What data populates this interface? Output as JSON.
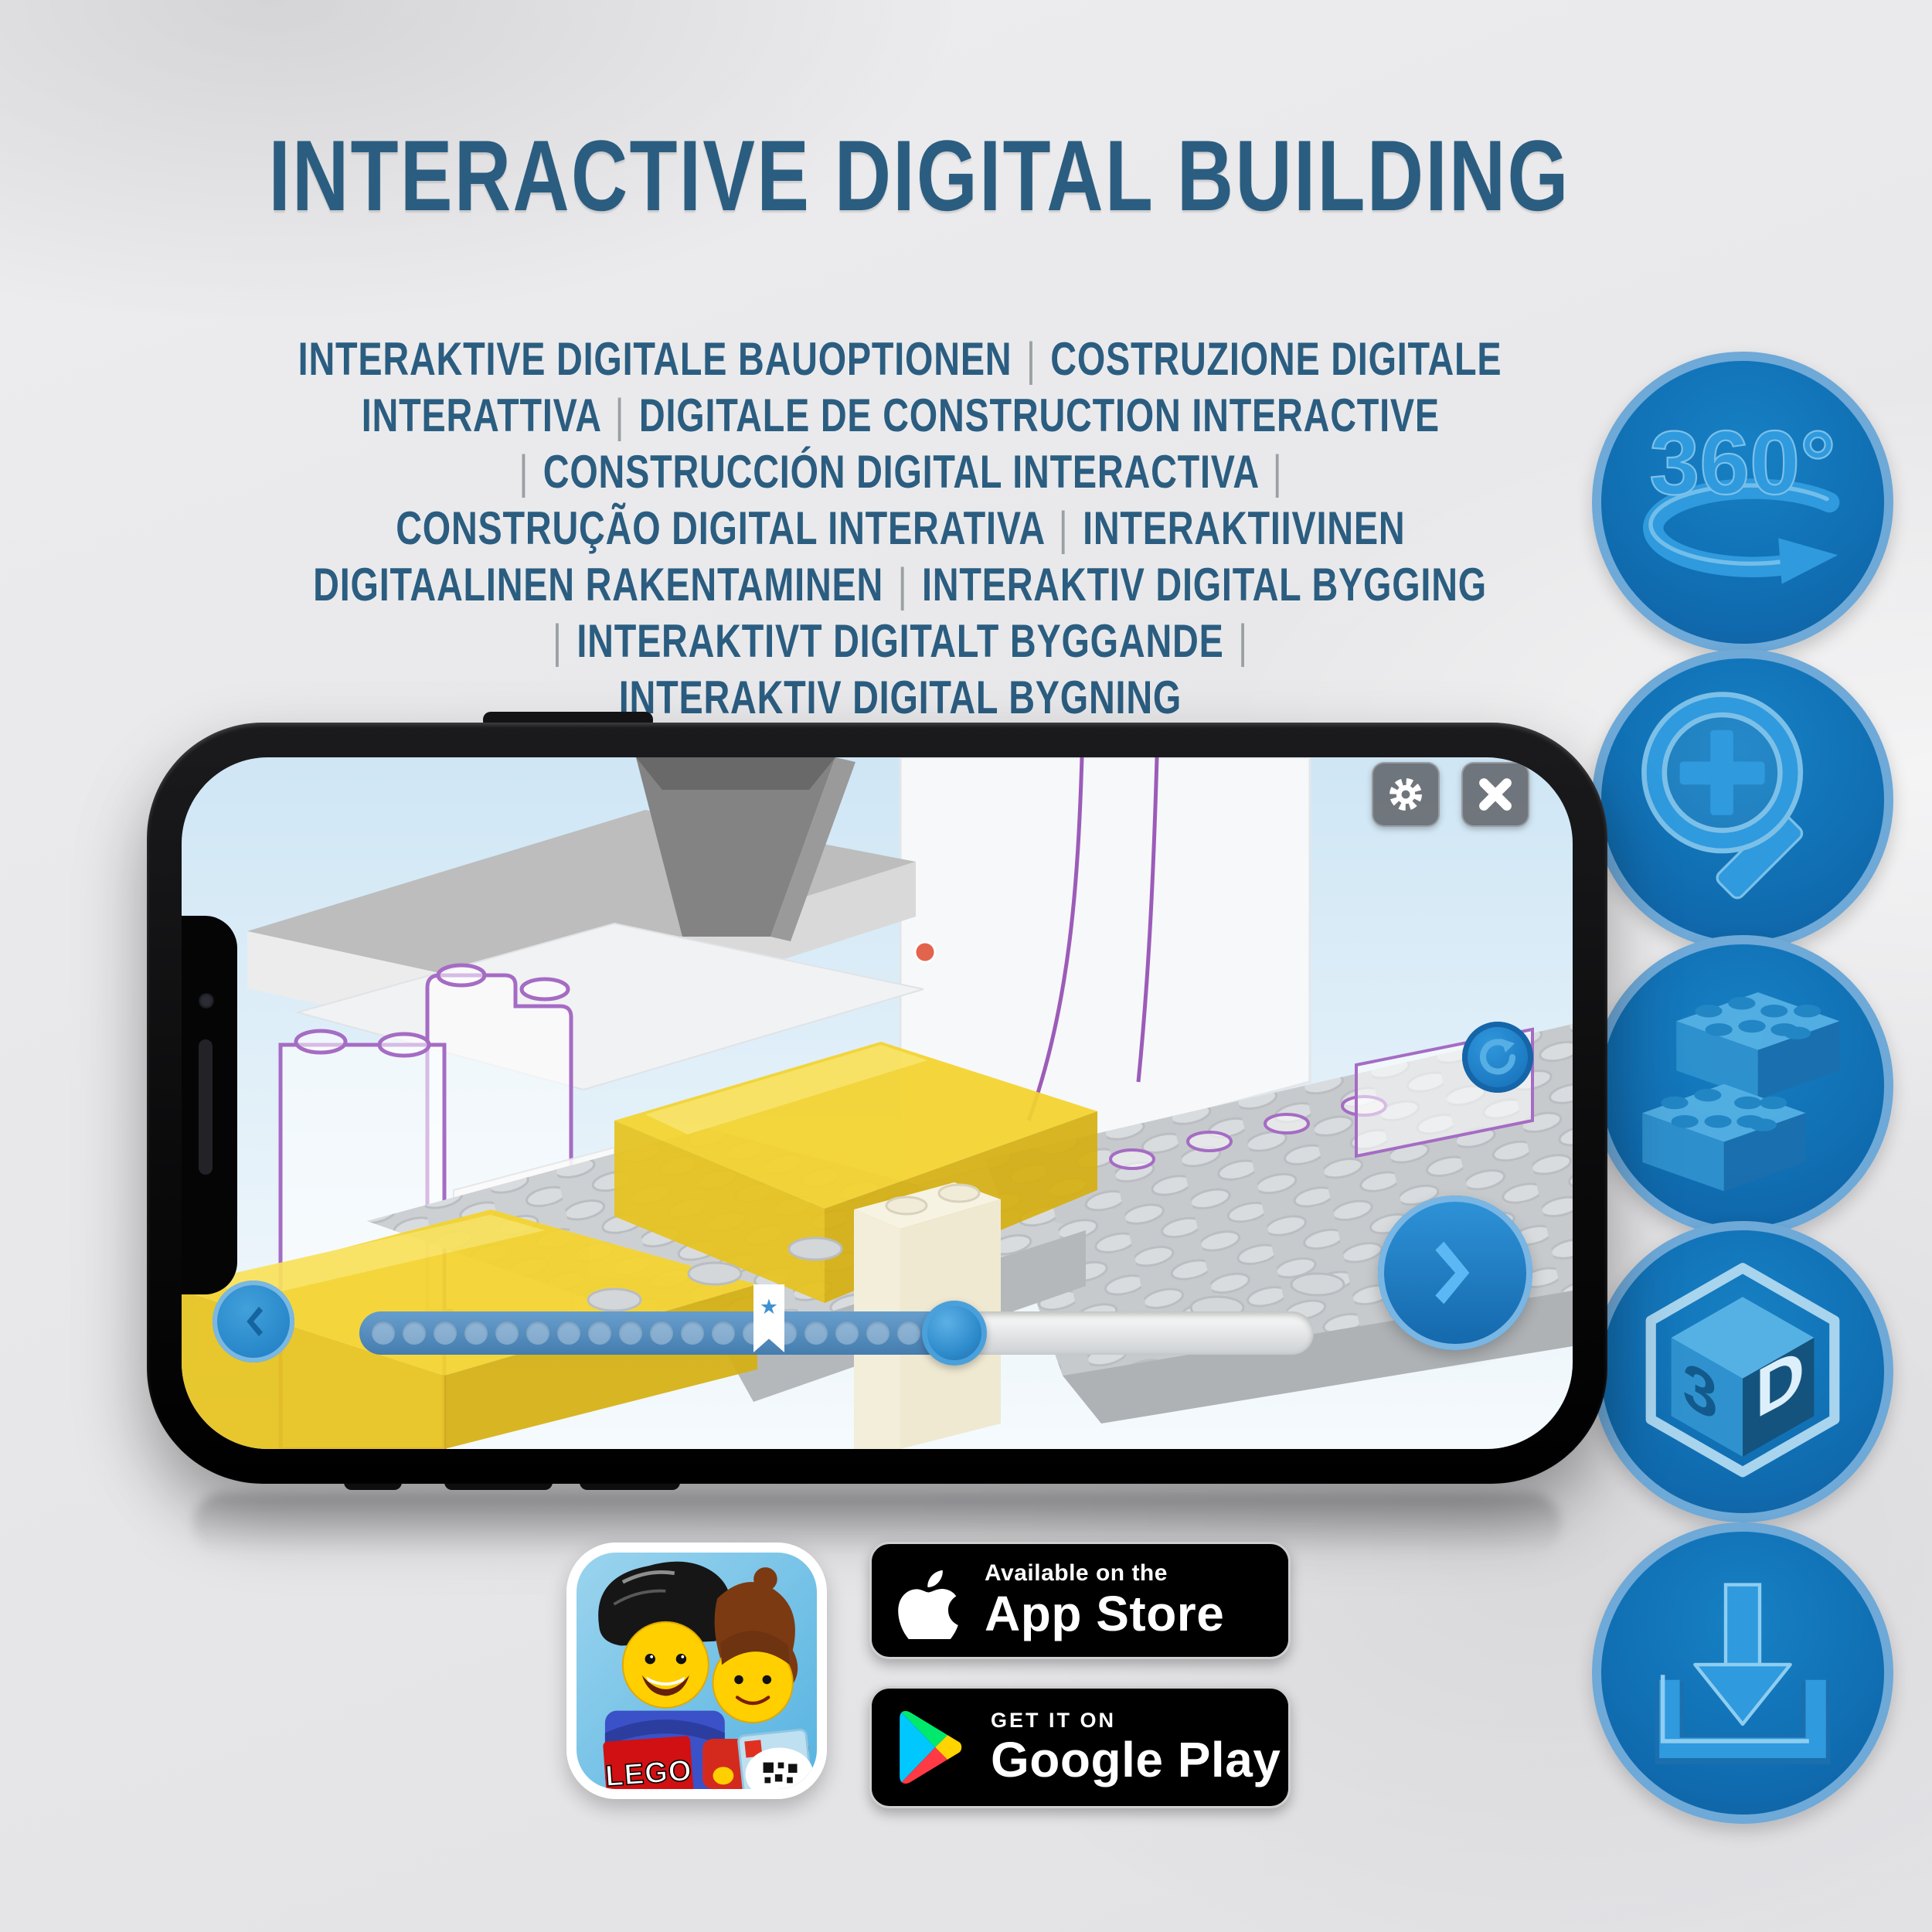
{
  "title": "INTERACTIVE DIGITAL BUILDING",
  "subtitle_lines": [
    "INTERAKTIVE DIGITALE BAUOPTIONEN | COSTRUZIONE DIGITALE",
    "INTERATTIVA | DIGITALE DE CONSTRUCTION INTERACTIVE",
    "| CONSTRUCCIÓN DIGITAL INTERACTIVA |",
    "CONSTRUÇÃO DIGITAL INTERATIVA | INTERAKTIIVINEN",
    "DIGITAALINEN RAKENTAMINEN | INTERAKTIV DIGITAL BYGGING",
    "| INTERAKTIVT DIGITALT BYGGANDE |",
    "INTERAKTIV DIGITAL BYGNING"
  ],
  "feature_badges": [
    {
      "name": "360-rotation",
      "label": "360°"
    },
    {
      "name": "zoom-in",
      "label": ""
    },
    {
      "name": "brick-options",
      "label": ""
    },
    {
      "name": "3d-view",
      "left": "3",
      "right": "D"
    },
    {
      "name": "download",
      "label": ""
    }
  ],
  "phone": {
    "progress_dots": 20
  },
  "store": {
    "lego_logo": "LEGO",
    "app_store": {
      "tagline": "Available on the",
      "name": "App Store"
    },
    "google_play": {
      "tagline": "GET IT ON",
      "name": "Google Play"
    }
  },
  "colors": {
    "title_blue": "#2b5d80",
    "pipe_gray": "#9aa0a4",
    "icon_circle_blue": "#1170b4",
    "icon_border_blue": "#6ea9d8",
    "icon_glyph_blue": "#2f9ade",
    "screen_sky": "#d7e9f6",
    "app_button_blue": "#2585c8",
    "lego_yellow": "#f4d42e",
    "ghost_outline_purple": "#a56cc4",
    "badge_black": "#000000"
  }
}
